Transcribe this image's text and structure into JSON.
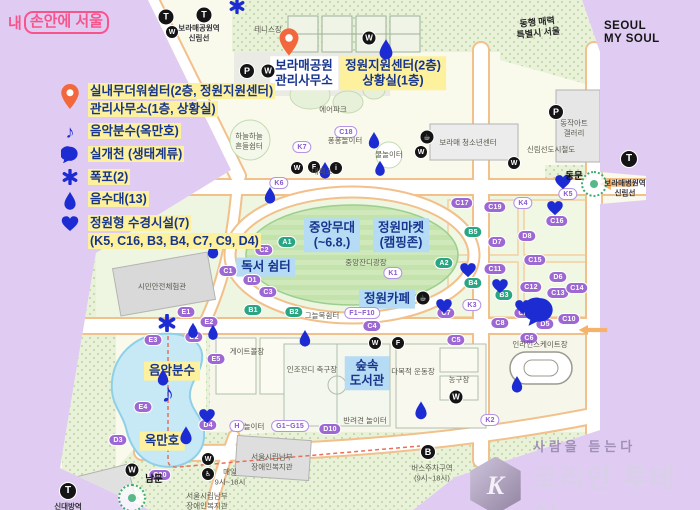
{
  "colors": {
    "lavender": "#e0ccf2",
    "map_cream": "#f9f9ec",
    "marker_blue": "#1d2bd3",
    "pin_orange": "#f2683c",
    "label_navy": "#17358d",
    "highlight_yellow": "#fdf19d",
    "highlight_blue": "#b5dcf4",
    "pill_purple": "#9d68d3",
    "pill_green": "#2aa583",
    "logo_pink": "#f8548c"
  },
  "branding": {
    "my_seoul_prefix": "내",
    "my_seoul_boxed": "손안에 서울",
    "slogan_line1": "동행 매력",
    "slogan_line2": "특별시 서울",
    "seoul_logo_line1": "SEOUL",
    "seoul_logo_line2": "MY SOUL"
  },
  "watermark": {
    "mark": "K",
    "tagline": "사람을 듣는다",
    "name": "코리안 투데이"
  },
  "legend": {
    "items": [
      {
        "id": "shelter",
        "icon": "pin",
        "size": 20,
        "lines": [
          "실내무더워쉼터(2층, 정원지원센터)",
          "관리사무소(1층, 상황실)"
        ]
      },
      {
        "id": "fountain",
        "icon": "note",
        "size": 18,
        "lines": [
          "음악분수(옥만호)"
        ]
      },
      {
        "id": "stream",
        "icon": "bubble",
        "size": 18,
        "lines": [
          "실개천 (생태계류)"
        ]
      },
      {
        "id": "waterfall",
        "icon": "asterisk",
        "size": 16,
        "lines": [
          "폭포(2)"
        ]
      },
      {
        "id": "drinking",
        "icon": "drop",
        "size": 14,
        "lines": [
          "음수대(13)"
        ]
      },
      {
        "id": "garden-water",
        "icon": "heart",
        "size": 18,
        "lines": [
          "정원형 수경시설(7)",
          "(K5, C16, B3, B4, C7, C9, D4)"
        ]
      }
    ]
  },
  "map": {
    "icon_glyphs": {
      "subway": "T",
      "toilet": "W",
      "parking": "P",
      "info": "i",
      "coffee": "☕",
      "food": "F",
      "bus": "B",
      "wheelchair": "♿"
    },
    "items": [
      {
        "k": "callout",
        "style": "white",
        "lines": [
          "보라매공원",
          "관리사무소"
        ],
        "x": 304,
        "y": 73,
        "n": "callout-park-office"
      },
      {
        "k": "callout",
        "style": "yellow",
        "lines": [
          "정원지원센터(2층)",
          "상황실(1층)"
        ],
        "x": 393,
        "y": 73,
        "n": "callout-garden-center"
      },
      {
        "k": "callout",
        "style": "blue",
        "lines": [
          "중앙무대",
          "(~6.8.)"
        ],
        "x": 332,
        "y": 235,
        "n": "callout-main-stage"
      },
      {
        "k": "callout",
        "style": "blue",
        "lines": [
          "정원마켓",
          "(캠핑존)"
        ],
        "x": 401,
        "y": 235,
        "n": "callout-garden-market"
      },
      {
        "k": "callout",
        "style": "blue",
        "lines": [
          "독서 쉼터"
        ],
        "x": 266,
        "y": 267,
        "n": "callout-reading-rest"
      },
      {
        "k": "callout",
        "style": "blue",
        "lines": [
          "정원카페"
        ],
        "x": 387,
        "y": 299,
        "n": "callout-garden-cafe"
      },
      {
        "k": "callout",
        "style": "blue",
        "lines": [
          "숲속",
          "도서관"
        ],
        "x": 367,
        "y": 373,
        "n": "callout-forest-library"
      },
      {
        "k": "callout",
        "style": "yellow",
        "lines": [
          "음악분수"
        ],
        "x": 172,
        "y": 371,
        "n": "callout-music-fountain"
      },
      {
        "k": "callout",
        "style": "yellow",
        "lines": [
          "옥만호"
        ],
        "x": 162,
        "y": 441,
        "n": "callout-okmanho"
      },
      {
        "k": "pill",
        "variant": "purple",
        "text": "C1",
        "x": 228,
        "y": 271
      },
      {
        "k": "pill",
        "variant": "purple",
        "text": "C2",
        "x": 264,
        "y": 250
      },
      {
        "k": "pill",
        "variant": "purple",
        "text": "C3",
        "x": 268,
        "y": 292
      },
      {
        "k": "pill",
        "variant": "purple",
        "text": "D1",
        "x": 252,
        "y": 280
      },
      {
        "k": "pill",
        "variant": "purple",
        "text": "C17",
        "x": 462,
        "y": 203
      },
      {
        "k": "pill",
        "variant": "purple",
        "text": "C19",
        "x": 495,
        "y": 207
      },
      {
        "k": "pill",
        "variant": "purple",
        "text": "C16",
        "x": 557,
        "y": 221
      },
      {
        "k": "pill",
        "variant": "purple",
        "text": "D7",
        "x": 497,
        "y": 242
      },
      {
        "k": "pill",
        "variant": "purple",
        "text": "D8",
        "x": 527,
        "y": 236
      },
      {
        "k": "pill",
        "variant": "purple",
        "text": "C15",
        "x": 535,
        "y": 260
      },
      {
        "k": "pill",
        "variant": "purple",
        "text": "C11",
        "x": 495,
        "y": 269
      },
      {
        "k": "pill",
        "variant": "purple",
        "text": "C12",
        "x": 531,
        "y": 287
      },
      {
        "k": "pill",
        "variant": "purple",
        "text": "D6",
        "x": 558,
        "y": 277
      },
      {
        "k": "pill",
        "variant": "purple",
        "text": "C13",
        "x": 558,
        "y": 293
      },
      {
        "k": "pill",
        "variant": "purple",
        "text": "C14",
        "x": 577,
        "y": 288
      },
      {
        "k": "pill",
        "variant": "purple",
        "text": "C7",
        "x": 446,
        "y": 313
      },
      {
        "k": "pill",
        "variant": "purple",
        "text": "C9",
        "x": 523,
        "y": 313
      },
      {
        "k": "pill",
        "variant": "purple",
        "text": "C10",
        "x": 569,
        "y": 319
      },
      {
        "k": "pill",
        "variant": "purple",
        "text": "D5",
        "x": 545,
        "y": 324
      },
      {
        "k": "pill",
        "variant": "purple",
        "text": "C8",
        "x": 500,
        "y": 323
      },
      {
        "k": "pill",
        "variant": "purple",
        "text": "C6",
        "x": 529,
        "y": 338
      },
      {
        "k": "pill",
        "variant": "purple",
        "text": "C5",
        "x": 456,
        "y": 340
      },
      {
        "k": "pill",
        "variant": "purple",
        "text": "C4",
        "x": 372,
        "y": 326
      },
      {
        "k": "pill",
        "variant": "purple",
        "text": "D2",
        "x": 194,
        "y": 337
      },
      {
        "k": "pill",
        "variant": "purple",
        "text": "D3",
        "x": 118,
        "y": 440
      },
      {
        "k": "pill",
        "variant": "purple",
        "text": "D4",
        "x": 208,
        "y": 425
      },
      {
        "k": "pill",
        "variant": "purple",
        "text": "E1",
        "x": 186,
        "y": 312
      },
      {
        "k": "pill",
        "variant": "purple",
        "text": "E2",
        "x": 209,
        "y": 322
      },
      {
        "k": "pill",
        "variant": "purple",
        "text": "E3",
        "x": 153,
        "y": 340
      },
      {
        "k": "pill",
        "variant": "purple",
        "text": "E4",
        "x": 143,
        "y": 407
      },
      {
        "k": "pill",
        "variant": "purple",
        "text": "E5",
        "x": 216,
        "y": 359
      },
      {
        "k": "pill",
        "variant": "purple",
        "text": "C20",
        "x": 160,
        "y": 475
      },
      {
        "k": "pill",
        "variant": "purple",
        "text": "D10",
        "x": 330,
        "y": 429
      },
      {
        "k": "pill",
        "variant": "green",
        "text": "A1",
        "x": 287,
        "y": 242
      },
      {
        "k": "pill",
        "variant": "green",
        "text": "A2",
        "x": 444,
        "y": 263
      },
      {
        "k": "pill",
        "variant": "green",
        "text": "B1",
        "x": 253,
        "y": 310
      },
      {
        "k": "pill",
        "variant": "green",
        "text": "B2",
        "x": 294,
        "y": 312
      },
      {
        "k": "pill",
        "variant": "green",
        "text": "B3",
        "x": 504,
        "y": 295
      },
      {
        "k": "pill",
        "variant": "green",
        "text": "B4",
        "x": 473,
        "y": 283
      },
      {
        "k": "pill",
        "variant": "green",
        "text": "B5",
        "x": 473,
        "y": 232
      },
      {
        "k": "pill",
        "variant": "white",
        "text": "K1",
        "x": 393,
        "y": 273
      },
      {
        "k": "pill",
        "variant": "white",
        "text": "K2",
        "x": 490,
        "y": 420
      },
      {
        "k": "pill",
        "variant": "white",
        "text": "K3",
        "x": 472,
        "y": 305
      },
      {
        "k": "pill",
        "variant": "white",
        "text": "K4",
        "x": 523,
        "y": 203
      },
      {
        "k": "pill",
        "variant": "white",
        "text": "K5",
        "x": 568,
        "y": 194
      },
      {
        "k": "pill",
        "variant": "white",
        "text": "K6",
        "x": 279,
        "y": 183
      },
      {
        "k": "pill",
        "variant": "white",
        "text": "K7",
        "x": 302,
        "y": 147
      },
      {
        "k": "pill",
        "variant": "white",
        "text": "C18",
        "x": 346,
        "y": 132
      },
      {
        "k": "pill",
        "variant": "white",
        "text": "F1~F10",
        "x": 362,
        "y": 313
      },
      {
        "k": "pill",
        "variant": "white",
        "text": "G1~G15",
        "x": 290,
        "y": 426
      },
      {
        "k": "pill",
        "variant": "white",
        "text": "H",
        "x": 237,
        "y": 426
      },
      {
        "k": "sym",
        "type": "pin",
        "x": 289,
        "y": 42,
        "s": 22
      },
      {
        "k": "sym",
        "type": "drop",
        "x": 386,
        "y": 49,
        "s": 16
      },
      {
        "k": "sym",
        "type": "drop",
        "x": 374,
        "y": 140,
        "s": 13
      },
      {
        "k": "sym",
        "type": "drop",
        "x": 325,
        "y": 170,
        "s": 13
      },
      {
        "k": "sym",
        "type": "drop",
        "x": 380,
        "y": 168,
        "s": 12
      },
      {
        "k": "sym",
        "type": "drop",
        "x": 270,
        "y": 195,
        "s": 13
      },
      {
        "k": "sym",
        "type": "drop",
        "x": 213,
        "y": 250,
        "s": 13
      },
      {
        "k": "sym",
        "type": "drop",
        "x": 193,
        "y": 330,
        "s": 12
      },
      {
        "k": "sym",
        "type": "drop",
        "x": 213,
        "y": 332,
        "s": 12
      },
      {
        "k": "sym",
        "type": "drop",
        "x": 305,
        "y": 338,
        "s": 13
      },
      {
        "k": "sym",
        "type": "drop",
        "x": 163,
        "y": 377,
        "s": 13
      },
      {
        "k": "sym",
        "type": "drop",
        "x": 421,
        "y": 410,
        "s": 14
      },
      {
        "k": "sym",
        "type": "drop",
        "x": 186,
        "y": 435,
        "s": 14
      },
      {
        "k": "sym",
        "type": "drop",
        "x": 517,
        "y": 384,
        "s": 13
      },
      {
        "k": "sym",
        "type": "heart",
        "x": 563,
        "y": 182,
        "s": 17
      },
      {
        "k": "sym",
        "type": "heart",
        "x": 555,
        "y": 208,
        "s": 17
      },
      {
        "k": "sym",
        "type": "heart",
        "x": 468,
        "y": 270,
        "s": 17
      },
      {
        "k": "sym",
        "type": "heart",
        "x": 500,
        "y": 286,
        "s": 17
      },
      {
        "k": "sym",
        "type": "heart",
        "x": 444,
        "y": 306,
        "s": 17
      },
      {
        "k": "sym",
        "type": "heart",
        "x": 523,
        "y": 307,
        "s": 17
      },
      {
        "k": "sym",
        "type": "heart",
        "x": 207,
        "y": 416,
        "s": 17
      },
      {
        "k": "sym",
        "type": "asterisk",
        "x": 167,
        "y": 323,
        "s": 18
      },
      {
        "k": "sym",
        "type": "asterisk",
        "x": 237,
        "y": 6,
        "s": 16
      },
      {
        "k": "sym",
        "type": "note",
        "x": 168,
        "y": 393,
        "s": 26
      },
      {
        "k": "sym",
        "type": "bubble",
        "x": 540,
        "y": 312,
        "s": 30
      },
      {
        "k": "sym",
        "type": "arrow",
        "x": 617,
        "y": 184,
        "s": 36
      },
      {
        "k": "sym",
        "type": "arrow",
        "x": 593,
        "y": 330,
        "s": 30
      },
      {
        "k": "ring",
        "x": 594,
        "y": 184,
        "r": 11
      },
      {
        "k": "ring",
        "x": 132,
        "y": 498,
        "r": 12
      },
      {
        "k": "icon",
        "type": "subway",
        "x": 166,
        "y": 17,
        "s": 15
      },
      {
        "k": "icon",
        "type": "subway",
        "x": 204,
        "y": 15,
        "s": 15
      },
      {
        "k": "icon",
        "type": "toilet",
        "x": 172,
        "y": 32,
        "s": 12
      },
      {
        "k": "icon",
        "type": "toilet",
        "x": 369,
        "y": 38,
        "s": 13
      },
      {
        "k": "icon",
        "type": "parking",
        "x": 247,
        "y": 71,
        "s": 14
      },
      {
        "k": "icon",
        "type": "toilet",
        "x": 268,
        "y": 71,
        "s": 13
      },
      {
        "k": "icon",
        "type": "toilet",
        "x": 297,
        "y": 168,
        "s": 12
      },
      {
        "k": "icon",
        "type": "food",
        "x": 314,
        "y": 167,
        "s": 12
      },
      {
        "k": "icon",
        "type": "info",
        "x": 336,
        "y": 168,
        "s": 12
      },
      {
        "k": "icon",
        "type": "coffee",
        "x": 427,
        "y": 137,
        "s": 13
      },
      {
        "k": "icon",
        "type": "toilet",
        "x": 421,
        "y": 152,
        "s": 12
      },
      {
        "k": "icon",
        "type": "toilet",
        "x": 514,
        "y": 163,
        "s": 12
      },
      {
        "k": "icon",
        "type": "parking",
        "x": 556,
        "y": 112,
        "s": 14
      },
      {
        "k": "icon",
        "type": "subway",
        "x": 629,
        "y": 159,
        "s": 16
      },
      {
        "k": "icon",
        "type": "toilet",
        "x": 375,
        "y": 343,
        "s": 12
      },
      {
        "k": "icon",
        "type": "food",
        "x": 398,
        "y": 343,
        "s": 12
      },
      {
        "k": "icon",
        "type": "toilet",
        "x": 456,
        "y": 397,
        "s": 13
      },
      {
        "k": "icon",
        "type": "toilet",
        "x": 132,
        "y": 470,
        "s": 13
      },
      {
        "k": "icon",
        "type": "toilet",
        "x": 208,
        "y": 459,
        "s": 12
      },
      {
        "k": "icon",
        "type": "wheelchair",
        "x": 208,
        "y": 474,
        "s": 12
      },
      {
        "k": "icon",
        "type": "bus",
        "x": 428,
        "y": 452,
        "s": 14
      },
      {
        "k": "icon",
        "type": "subway",
        "x": 68,
        "y": 491,
        "s": 16
      },
      {
        "k": "icon",
        "type": "coffee",
        "x": 423,
        "y": 298,
        "s": 13
      },
      {
        "k": "label",
        "cls": "dark",
        "text": "보라매공원역\n신림선",
        "x": 199,
        "y": 33
      },
      {
        "k": "label",
        "text": "테니스장",
        "x": 268,
        "y": 30
      },
      {
        "k": "label",
        "text": "에어파크",
        "x": 333,
        "y": 110
      },
      {
        "k": "label",
        "text": "하늘하늘\n흔들쉼터",
        "x": 249,
        "y": 141
      },
      {
        "k": "label",
        "text": "퐁퐁놀이터",
        "x": 345,
        "y": 141
      },
      {
        "k": "label",
        "text": "물놀이터",
        "x": 389,
        "y": 155
      },
      {
        "k": "label",
        "text": "대피소",
        "x": 322,
        "y": 172
      },
      {
        "k": "label",
        "text": "보라매 청소년센터",
        "x": 468,
        "y": 143
      },
      {
        "k": "label",
        "text": "신림선도시철도",
        "x": 551,
        "y": 150
      },
      {
        "k": "label",
        "text": "동작아트\n갤러리",
        "x": 574,
        "y": 128
      },
      {
        "k": "label",
        "cls": "dark",
        "text": "보라매병원역\n신림선",
        "x": 625,
        "y": 188
      },
      {
        "k": "label",
        "text": "시민안전체험관",
        "x": 162,
        "y": 287
      },
      {
        "k": "label",
        "text": "중앙잔디광장",
        "x": 366,
        "y": 263
      },
      {
        "k": "label",
        "text": "그늘목쉼터",
        "x": 322,
        "y": 316
      },
      {
        "k": "label",
        "text": "게이트볼장",
        "x": 247,
        "y": 352
      },
      {
        "k": "label",
        "text": "인조잔디 축구장",
        "x": 312,
        "y": 370
      },
      {
        "k": "label",
        "text": "다목적 운동장",
        "x": 413,
        "y": 372
      },
      {
        "k": "label",
        "text": "농구장",
        "x": 459,
        "y": 380
      },
      {
        "k": "label",
        "text": "인라인스케이트장",
        "x": 540,
        "y": 345
      },
      {
        "k": "label",
        "text": "반려견 놀이터",
        "x": 365,
        "y": 421
      },
      {
        "k": "label",
        "text": "놀이터",
        "x": 254,
        "y": 427
      },
      {
        "k": "label",
        "text": "매일\n9시~18시",
        "x": 230,
        "y": 477
      },
      {
        "k": "label",
        "text": "버스주차구역\n(9시~18시)",
        "x": 432,
        "y": 473
      },
      {
        "k": "label",
        "text": "서울시립남부\n장애인복지관",
        "x": 272,
        "y": 462
      },
      {
        "k": "label",
        "text": "서울시립남부\n장애인복지관",
        "x": 207,
        "y": 501
      },
      {
        "k": "label",
        "cls": "dark",
        "text": "신대방역",
        "x": 68,
        "y": 507
      },
      {
        "k": "label",
        "cls": "gate",
        "text": "남문",
        "x": 154,
        "y": 480
      },
      {
        "k": "label",
        "cls": "gate",
        "text": "동문",
        "x": 574,
        "y": 177
      }
    ]
  }
}
